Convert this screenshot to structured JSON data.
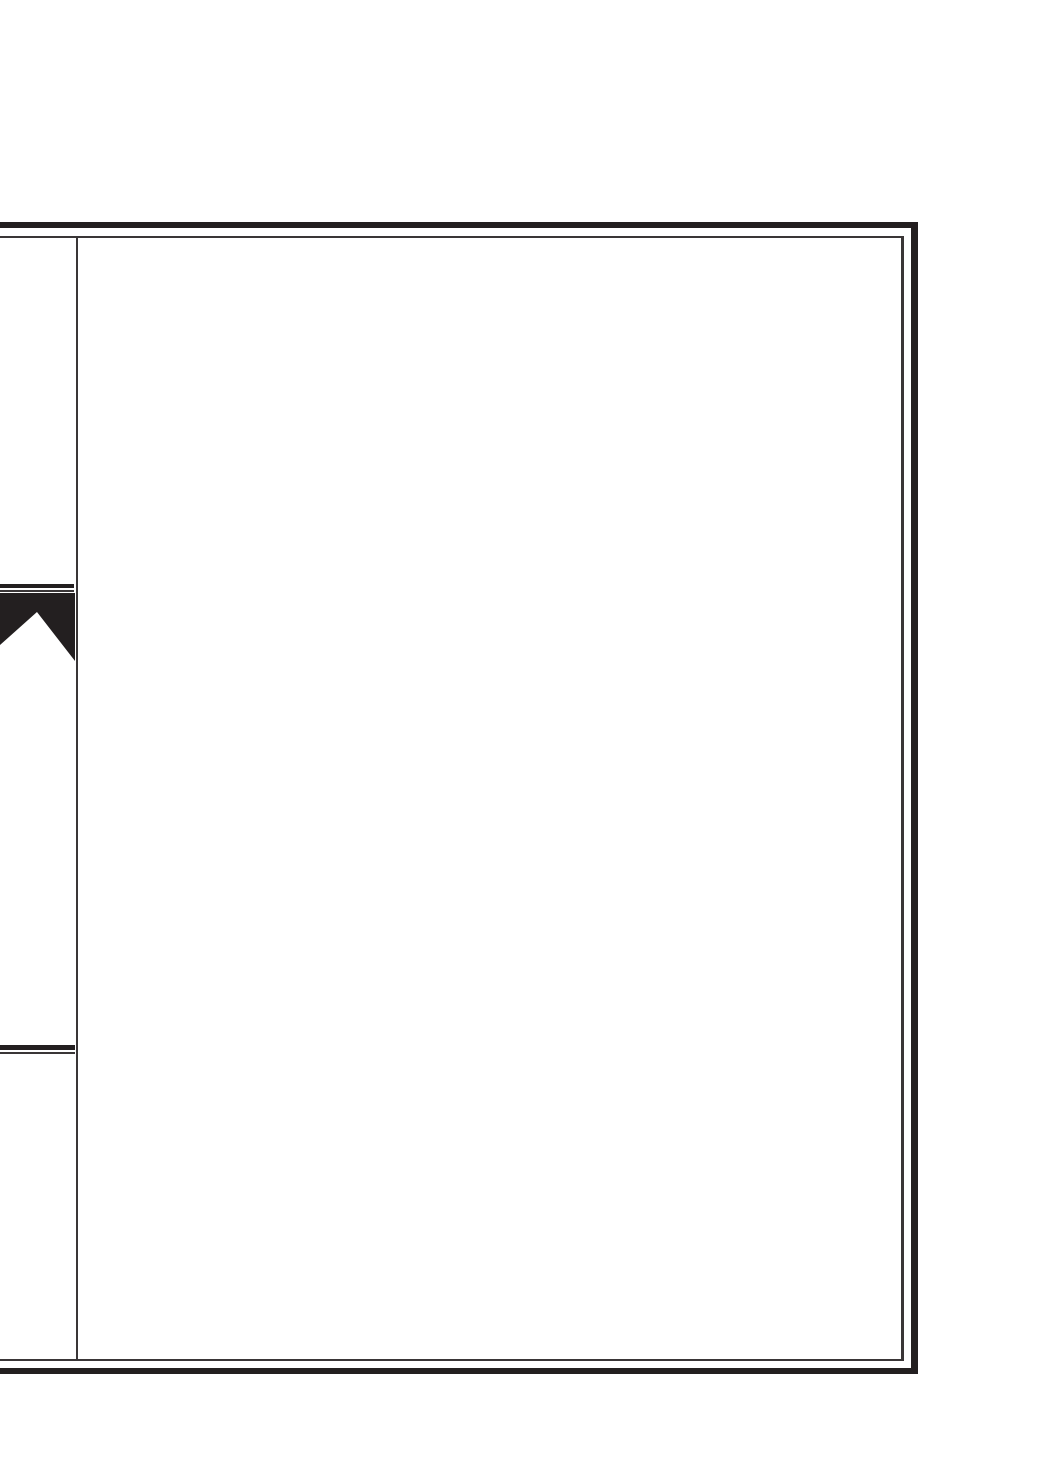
{
  "document": {
    "kind": "scanned-blank-page",
    "visible_text": "",
    "icons": [
      {
        "name": "bookmark-tab-icon",
        "description": "black swallow-tail banner tab with inverted-V notch at bottom"
      }
    ]
  },
  "colors": {
    "paper": "#ffffff",
    "ink": "#231f20",
    "ink-light": "#3a3637"
  }
}
